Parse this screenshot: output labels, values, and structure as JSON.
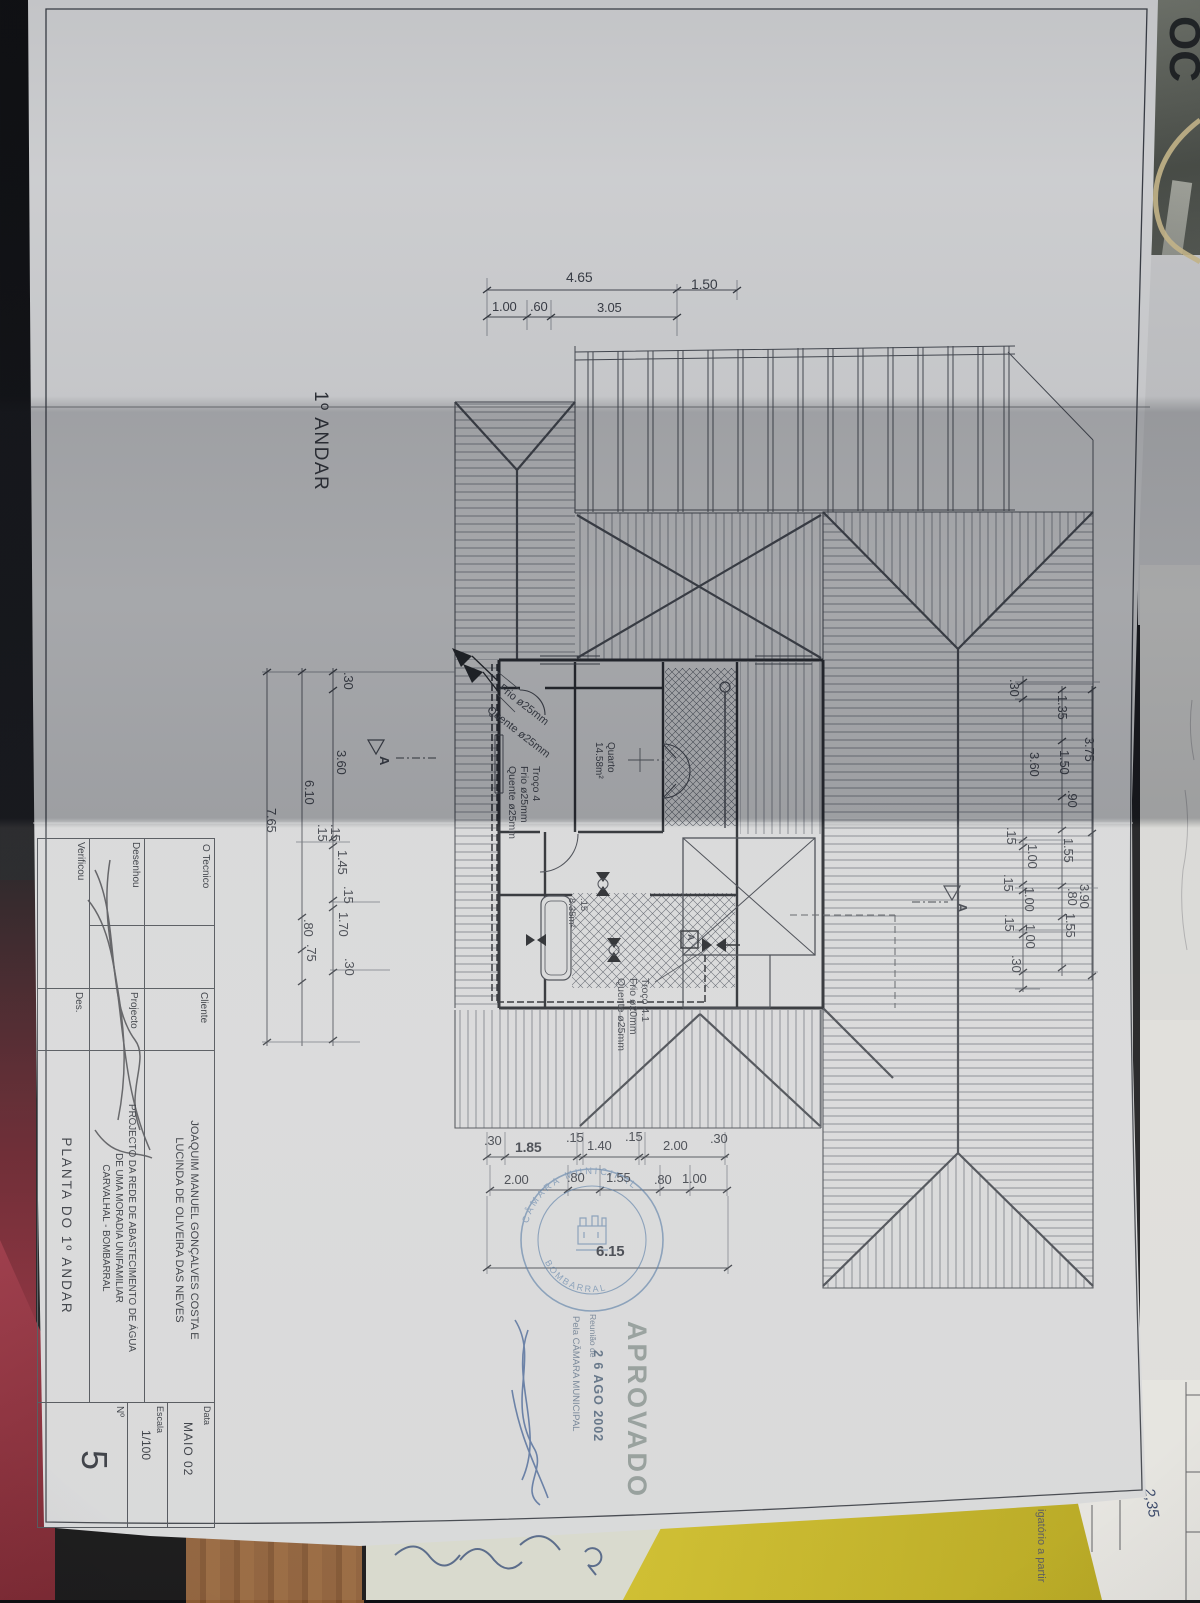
{
  "sheet": {
    "floor_label": "1º ANDAR"
  },
  "title_block": {
    "row1": {
      "label": "O Tecnico",
      "col2": "Cliente",
      "client_line1": "JOAQUIM MANUEL GONÇALVES COSTA E",
      "client_line2": "LUCINDA DE OLIVEIRA DAS NEVES",
      "meta_label": "Data",
      "meta_value": "MAIO 02"
    },
    "row2": {
      "label": "Desenhou",
      "col2": "Projecto",
      "project_line1": "PROJECTO DA REDE DE ABASTECIMENTO DE ÁGUA",
      "project_line2": "DE UMA MORADIA UNIFAMILIAR",
      "project_line3": "CARVALHAL - BOMBARRAL",
      "meta_label": "Escala",
      "meta_value": "1/100"
    },
    "row3": {
      "label": "Verificou",
      "col2": "Des.",
      "title": "PLANTA DO 1º ANDAR",
      "meta_label": "Nº",
      "meta_value": "5"
    }
  },
  "stamp": {
    "approved": "APROVADO",
    "meeting": "Reunião de",
    "date": "2 6 AGO 2002",
    "by": "Pela CÂMARA MUNICIPAL",
    "ring_top": "CÂMARA MUNICIPAL",
    "ring_bottom": "BOMBARRAL"
  },
  "rooms": {
    "quarto": "Quarto",
    "quarto_area": "14.58m²",
    "bath_dim": ".15",
    "bath_area": "8.35m²"
  },
  "pipes": {
    "frio25": "Frio ø25mm",
    "quente25": "Quente ø25mm",
    "troco4": "Troço 4",
    "troco4_frio": "Frio ø25mm",
    "troco4_quente": "Quente ø25mm",
    "troco41": "Troço 4.1",
    "troco41_frio": "Frio ø20mm",
    "troco41_quente": "Quente ø25mm"
  },
  "markers": {
    "section": "A",
    "valve_box": "A"
  },
  "dims": {
    "top1": [
      "4.65",
      "1.50"
    ],
    "top2": [
      "1.00",
      ".60",
      "3.05"
    ],
    "left_outer": "7.65",
    "left_mid": "6.10",
    "left_chain": [
      ".30",
      "3.60",
      ".15",
      ".15",
      "1.45",
      ".15",
      "1.70",
      ".80",
      ".75",
      ".30"
    ],
    "right_inner": [
      ".30",
      "3.60",
      ".15",
      "1.00",
      ".15",
      "1.00",
      ".15",
      "1.00",
      ".30"
    ],
    "right_mid": [
      "1.35",
      "1.50",
      ".90",
      "1.55",
      ".80",
      "1.55"
    ],
    "right_outer": [
      "3.75",
      "3.90"
    ],
    "bottom1": [
      ".30",
      "1.85",
      ".15",
      "1.40",
      ".15",
      "2.00",
      ".30"
    ],
    "bottom2": [
      "2.00",
      ".80",
      "1.55",
      ".80",
      "1.00"
    ],
    "bottom_total": "6.15"
  },
  "background": {
    "doc_letters": "OC",
    "partial_text": "igatório a partir",
    "handwritten_value": "2,35"
  }
}
